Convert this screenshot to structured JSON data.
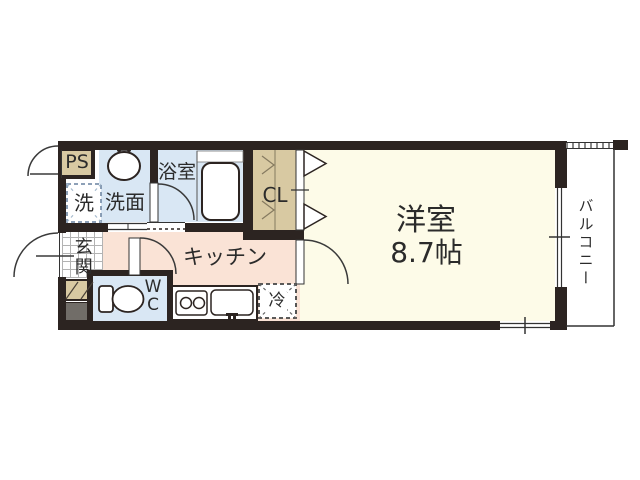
{
  "floorplan": {
    "rooms": {
      "western_room": {
        "name": "洋室",
        "size": "8.7帖"
      },
      "kitchen": {
        "label": "キッチン"
      },
      "bathroom": {
        "label": "浴室"
      },
      "washroom": {
        "label": "洗面"
      },
      "laundry": {
        "label": "洗"
      },
      "toilet": {
        "line1": "W",
        "line2": "C"
      },
      "entrance": {
        "label": "玄関"
      },
      "closet": {
        "label": "CL"
      },
      "pipe_space": {
        "label": "PS"
      },
      "refrigerator": {
        "label": "冷"
      },
      "balcony": {
        "label": "バルコニー"
      }
    },
    "colors": {
      "wall": "#2c2421",
      "room_cream": "#fdfbe8",
      "kitchen_pink": "#fae3d6",
      "wet_blue": "#d9e7f4",
      "closet_tan": "#d8c9a2",
      "meter_gray": "#716d68"
    }
  }
}
